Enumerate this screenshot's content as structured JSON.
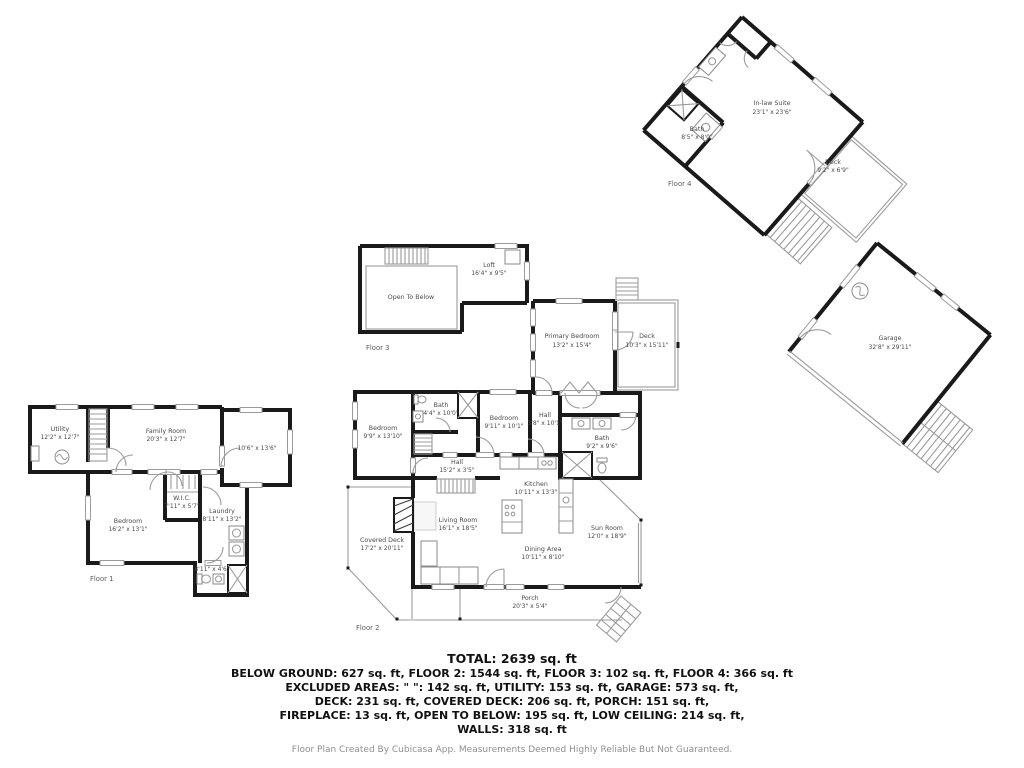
{
  "floors": {
    "floor1": {
      "label": "Floor 1",
      "rooms": {
        "utility": {
          "name": "Utility",
          "dims": "12'2\" x 12'7\""
        },
        "family_room": {
          "name": "Family Room",
          "dims": "20'3\" x 12'7\""
        },
        "rec_room": {
          "name": "",
          "dims": "10'6\" x 13'6\""
        },
        "bedroom": {
          "name": "Bedroom",
          "dims": "16'2\" x 13'1\""
        },
        "wic": {
          "name": "W.I.C.",
          "dims": "7'11\" x 5'7\""
        },
        "laundry": {
          "name": "Laundry",
          "dims": "8'11\" x 13'2\""
        },
        "bath": {
          "name": "",
          "dims": "8'11\" x 4'6\""
        }
      }
    },
    "floor2": {
      "label": "Floor 2",
      "rooms": {
        "primary_bedroom": {
          "name": "Primary Bedroom",
          "dims": "13'2\" x 15'4\""
        },
        "deck": {
          "name": "Deck",
          "dims": "10'3\" x 15'11\""
        },
        "bedroom_left": {
          "name": "Bedroom",
          "dims": "9'9\" x 13'10\""
        },
        "bath_small": {
          "name": "Bath",
          "dims": "4'4\" x 10'0\""
        },
        "bedroom_mid": {
          "name": "Bedroom",
          "dims": "9'11\" x 10'1\""
        },
        "hall_upper": {
          "name": "Hall",
          "dims": "3'8\" x 10'1\""
        },
        "bath_main": {
          "name": "Bath",
          "dims": "9'2\" x 9'6\""
        },
        "hall": {
          "name": "Hall",
          "dims": "15'2\" x 3'5\""
        },
        "kitchen": {
          "name": "Kitchen",
          "dims": "10'11\" x 13'3\""
        },
        "living_room": {
          "name": "Living Room",
          "dims": "16'1\" x 18'5\""
        },
        "dining_area": {
          "name": "Dining Area",
          "dims": "10'11\" x 8'10\""
        },
        "sun_room": {
          "name": "Sun Room",
          "dims": "12'0\" x 18'9\""
        },
        "covered_deck": {
          "name": "Covered Deck",
          "dims": "17'2\" x 20'11\""
        },
        "porch": {
          "name": "Porch",
          "dims": "20'3\" x 5'4\""
        }
      }
    },
    "floor3": {
      "label": "Floor 3",
      "rooms": {
        "loft": {
          "name": "Loft",
          "dims": "16'4\" x 9'5\""
        },
        "open_to_below": {
          "name": "Open To Below",
          "dims": ""
        }
      }
    },
    "floor4": {
      "label": "Floor 4",
      "rooms": {
        "inlaw_suite": {
          "name": "In-law Suite",
          "dims": "23'1\" x 23'6\""
        },
        "bath": {
          "name": "Bath",
          "dims": "8'5\" x 8'0\""
        },
        "deck": {
          "name": "Deck",
          "dims": "9'2\" x 6'9\""
        }
      }
    },
    "garage": {
      "rooms": {
        "garage": {
          "name": "Garage",
          "dims": "32'8\" x 29'11\""
        }
      }
    }
  },
  "summary": {
    "total": "TOTAL: 2639 sq. ft",
    "line1": "BELOW GROUND: 627 sq. ft, FLOOR 2: 1544 sq. ft, FLOOR 3: 102 sq. ft, FLOOR 4: 366 sq. ft",
    "line2": "EXCLUDED AREAS: \" \": 142 sq. ft, UTILITY: 153 sq. ft, GARAGE: 573 sq. ft,",
    "line3": "DECK: 231 sq. ft, COVERED DECK: 206 sq. ft, PORCH: 151 sq. ft,",
    "line4": "FIREPLACE: 13 sq. ft, OPEN TO BELOW: 195 sq. ft, LOW CEILING: 214 sq. ft,",
    "line5": "WALLS: 318 sq. ft",
    "disclaimer": "Floor Plan Created By Cubicasa App. Measurements Deemed Highly Reliable But Not Guaranteed."
  },
  "colors": {
    "wall": "#1a1a1a",
    "outdoor_line": "#9b9b9b",
    "room_label": "#4a4a4a",
    "summary_text": "#111111",
    "disclaimer_text": "#909090"
  }
}
